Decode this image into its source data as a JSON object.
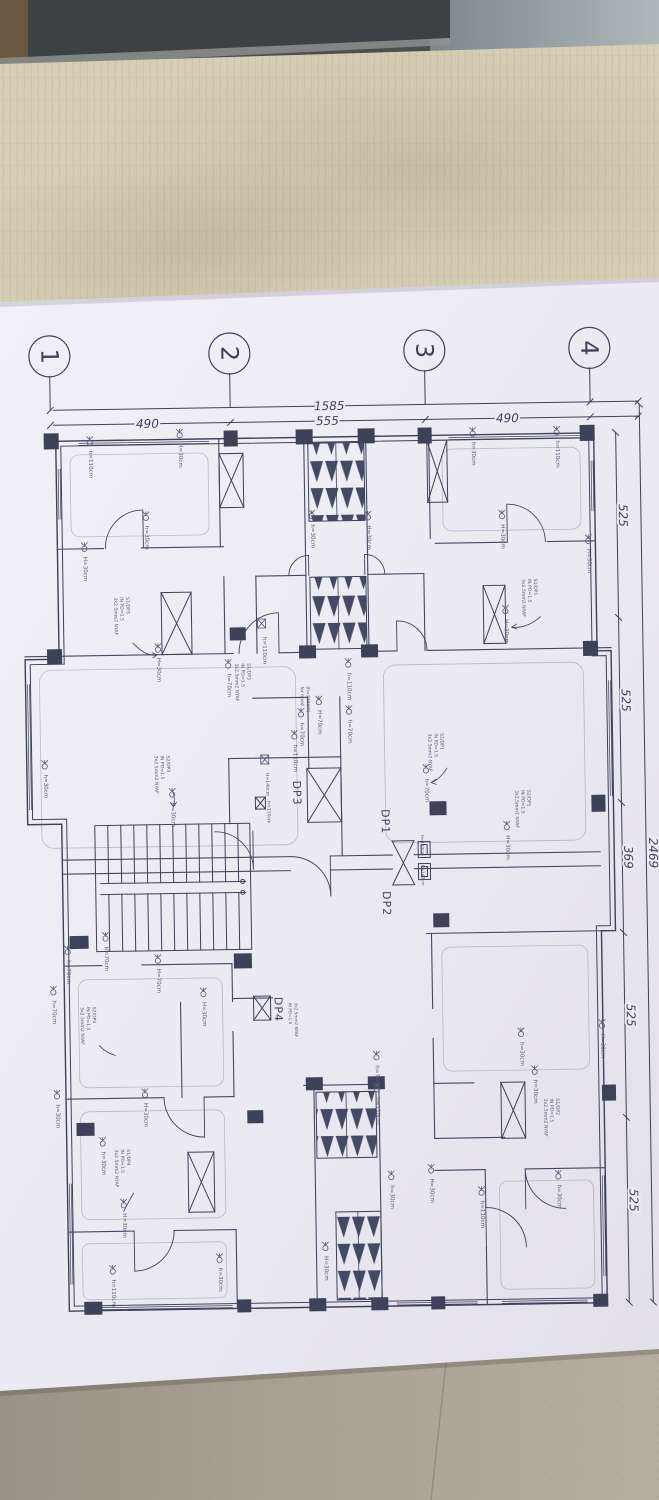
{
  "style": {
    "ink": "#3e4259",
    "ink_soft": "#565a75",
    "paper": "#edebf4",
    "paper_deep": "#e3e0ec",
    "beige_surface": "#d7ceb5",
    "top_object_dark": "#3c4144",
    "top_strip_brown": "#6b5642",
    "top_right_light": "#9aa5a9",
    "bottom_surface": "#a49e91"
  },
  "grid": {
    "bubbles": [
      {
        "label": "1",
        "x": 57
      },
      {
        "label": "2",
        "x": 237
      },
      {
        "label": "3",
        "x": 432
      },
      {
        "label": "4",
        "x": 597
      }
    ],
    "bubble_y": 352,
    "top_dims": {
      "total": {
        "text": "1585",
        "x": 336,
        "y": 410
      },
      "segments": [
        {
          "text": "490",
          "x": 154,
          "y": 425
        },
        {
          "text": "555",
          "x": 334,
          "y": 425
        },
        {
          "text": "490",
          "x": 514,
          "y": 425
        }
      ]
    },
    "right_dims": {
      "total": {
        "text": "2469",
        "x": 649,
        "y": 858
      },
      "segments": [
        {
          "text": "525",
          "x": 624,
          "y": 520
        },
        {
          "text": "525",
          "x": 624,
          "y": 705
        },
        {
          "text": "369",
          "x": 624,
          "y": 862
        },
        {
          "text": "525",
          "x": 624,
          "y": 1020
        },
        {
          "text": "525",
          "x": 624,
          "y": 1205
        }
      ]
    }
  },
  "panels": [
    {
      "label": "DP1",
      "x": 382,
      "y": 810
    },
    {
      "label": "DP2",
      "x": 382,
      "y": 892
    },
    {
      "label": "DP3",
      "x": 294,
      "y": 780
    },
    {
      "label": "DP4",
      "x": 272,
      "y": 996
    }
  ],
  "annotations": [
    {
      "x": 95,
      "y": 447,
      "t": "h=110cm",
      "sym": 1
    },
    {
      "x": 185,
      "y": 441,
      "t": "H=30cm",
      "sym": 1
    },
    {
      "x": 150,
      "y": 523,
      "t": "h=30cm",
      "sym": 1
    },
    {
      "x": 88,
      "y": 553,
      "t": "H=30cm",
      "sym": 1
    },
    {
      "x": 316,
      "y": 524,
      "t": "h=30cm",
      "sym": 1
    },
    {
      "x": 372,
      "y": 526,
      "t": "H=30cm",
      "sym": 1
    },
    {
      "x": 478,
      "y": 444,
      "t": "h=30cm",
      "sym": 1
    },
    {
      "x": 562,
      "y": 444,
      "t": "h=110cm",
      "sym": 1
    },
    {
      "x": 506,
      "y": 527,
      "t": "H=30cm",
      "sym": 1
    },
    {
      "x": 592,
      "y": 553,
      "t": "H=30cm",
      "sym": 1
    },
    {
      "x": 526,
      "y": 582,
      "t": "3x2.5mm2 NYAF",
      "s": 4.6
    },
    {
      "x": 532,
      "y": 582,
      "t": "IN PD=1.5",
      "s": 4.6
    },
    {
      "x": 538,
      "y": 582,
      "t": "S1/DP1",
      "s": 4.6
    },
    {
      "x": 508,
      "y": 622,
      "t": "H=30cm",
      "sym": 1
    },
    {
      "x": 118,
      "y": 594,
      "t": "3x2.5mm2 NYAF",
      "s": 4.6
    },
    {
      "x": 124,
      "y": 594,
      "t": "IN PD=1.5",
      "s": 4.6
    },
    {
      "x": 130,
      "y": 594,
      "t": "S1/DP3",
      "s": 4.6
    },
    {
      "x": 160,
      "y": 655,
      "t": "H=30cm",
      "sym": 1
    },
    {
      "x": 238,
      "y": 662,
      "t": "3x2.5mm2 NYAF",
      "s": 4.6
    },
    {
      "x": 244,
      "y": 662,
      "t": "IN PD=1.5",
      "s": 4.6
    },
    {
      "x": 250,
      "y": 662,
      "t": "S1/DP3",
      "s": 4.6
    },
    {
      "x": 230,
      "y": 672,
      "t": "h=70cm",
      "sym": 1
    },
    {
      "x": 266,
      "y": 636,
      "t": "h=110cm",
      "box": 1
    },
    {
      "x": 303,
      "y": 686,
      "t": "for hood",
      "s": 4.6
    },
    {
      "x": 309,
      "y": 686,
      "t": "(h=210cm)",
      "s": 4.6
    },
    {
      "x": 320,
      "y": 710,
      "t": "H=70cm",
      "sym": 1
    },
    {
      "x": 302,
      "y": 722,
      "t": "h=70cm",
      "sym": 1
    },
    {
      "x": 295,
      "y": 744,
      "t": "h=110cm",
      "sym": 1
    },
    {
      "x": 350,
      "y": 673,
      "t": "h=110cm",
      "sym": 1
    },
    {
      "x": 350,
      "y": 720,
      "t": "h=70cm",
      "sym": 1
    },
    {
      "x": 430,
      "y": 735,
      "t": "3x2.5mm2 NYAF",
      "s": 4.6
    },
    {
      "x": 436,
      "y": 735,
      "t": "IN PD=1.5",
      "s": 4.6
    },
    {
      "x": 442,
      "y": 735,
      "t": "S2/DP1",
      "s": 4.6
    },
    {
      "x": 426,
      "y": 780,
      "t": "h=70cm",
      "sym": 1
    },
    {
      "x": 516,
      "y": 793,
      "t": "3x2.5mm2 NYAF",
      "s": 4.6
    },
    {
      "x": 522,
      "y": 793,
      "t": "IN PD=1.5",
      "s": 4.6
    },
    {
      "x": 528,
      "y": 793,
      "t": "S2/DP1",
      "s": 4.6
    },
    {
      "x": 506,
      "y": 838,
      "t": "H=30cm",
      "sym": 1
    },
    {
      "x": 156,
      "y": 753,
      "t": "3x2.5mm2 NYAF",
      "s": 4.6
    },
    {
      "x": 162,
      "y": 753,
      "t": "IN PD=1.5",
      "s": 4.6
    },
    {
      "x": 168,
      "y": 753,
      "t": "S2/DP3",
      "s": 4.6
    },
    {
      "x": 172,
      "y": 800,
      "t": "H=30cm",
      "sym": 1
    },
    {
      "x": 45,
      "y": 770,
      "t": "h=30cm",
      "sym": 1
    },
    {
      "x": 267,
      "y": 772,
      "t": "H=140cm",
      "s": 4.6,
      "box": 1
    },
    {
      "x": 268,
      "y": 800,
      "t": "h=110cm",
      "s": 4.6
    },
    {
      "x": 421,
      "y": 836,
      "t": "H=140cm",
      "s": 4.2
    },
    {
      "x": 421,
      "y": 866,
      "t": "H=140cm",
      "s": 4.2
    },
    {
      "x": 78,
      "y": 1003,
      "t": "3x2.5mm2 NYAF",
      "s": 4.6
    },
    {
      "x": 84,
      "y": 1003,
      "t": "IN PD=1.5",
      "s": 4.6
    },
    {
      "x": 90,
      "y": 1003,
      "t": "S2/DP4",
      "s": 4.6
    },
    {
      "x": 65,
      "y": 956,
      "t": "h=70cm",
      "sym": 1
    },
    {
      "x": 50,
      "y": 996,
      "t": "h=70cm",
      "sym": 1
    },
    {
      "x": 103,
      "y": 943,
      "t": "H=70cm",
      "sym": 1
    },
    {
      "x": 155,
      "y": 966,
      "t": "H=70cm",
      "sym": 1
    },
    {
      "x": 200,
      "y": 1000,
      "t": "H=30cm",
      "sym": 1
    },
    {
      "x": 286,
      "y": 1002,
      "t": "IN PD=1.5",
      "s": 4.2
    },
    {
      "x": 292,
      "y": 1002,
      "t": "3x2.5mm2 NYAF",
      "s": 4.2
    },
    {
      "x": 372,
      "y": 1066,
      "t": "h=70cm",
      "sym": 1
    },
    {
      "x": 372,
      "y": 1098,
      "t": "h=110cm",
      "sym": 1
    },
    {
      "x": 110,
      "y": 1146,
      "t": "3x2.5mm2 NYAF",
      "s": 4.6
    },
    {
      "x": 116,
      "y": 1146,
      "t": "IN PD=1.5",
      "s": 4.6
    },
    {
      "x": 122,
      "y": 1146,
      "t": "S1/DP4",
      "s": 4.6
    },
    {
      "x": 52,
      "y": 1100,
      "t": "h=30cm",
      "sym": 1
    },
    {
      "x": 140,
      "y": 1100,
      "t": "H=30cm",
      "sym": 1
    },
    {
      "x": 97,
      "y": 1148,
      "t": "h=30cm",
      "sym": 1
    },
    {
      "x": 117,
      "y": 1210,
      "t": "H=30cm",
      "sym": 1
    },
    {
      "x": 105,
      "y": 1276,
      "t": "h=110cm",
      "sym": 1
    },
    {
      "x": 212,
      "y": 1266,
      "t": "h=30cm",
      "sym": 1
    },
    {
      "x": 318,
      "y": 1256,
      "t": "H=30cm",
      "sym": 1
    },
    {
      "x": 385,
      "y": 1186,
      "t": "h=30cm",
      "sym": 1
    },
    {
      "x": 540,
      "y": 1102,
      "t": "3x2.5mm2 NYAF",
      "s": 4.6
    },
    {
      "x": 546,
      "y": 1102,
      "t": "IN PD=1.5",
      "s": 4.6
    },
    {
      "x": 552,
      "y": 1102,
      "t": "S1/DP2",
      "s": 4.6
    },
    {
      "x": 517,
      "y": 1045,
      "t": "h=30cm",
      "sym": 1
    },
    {
      "x": 530,
      "y": 1083,
      "t": "h=30cm",
      "sym": 1
    },
    {
      "x": 598,
      "y": 1038,
      "t": "H=30cm",
      "sym": 1
    },
    {
      "x": 475,
      "y": 1203,
      "t": "h=110cm",
      "sym": 1
    },
    {
      "x": 425,
      "y": 1180,
      "t": "H=30cm",
      "sym": 1
    },
    {
      "x": 552,
      "y": 1188,
      "t": "h=30cm",
      "sym": 1
    }
  ]
}
